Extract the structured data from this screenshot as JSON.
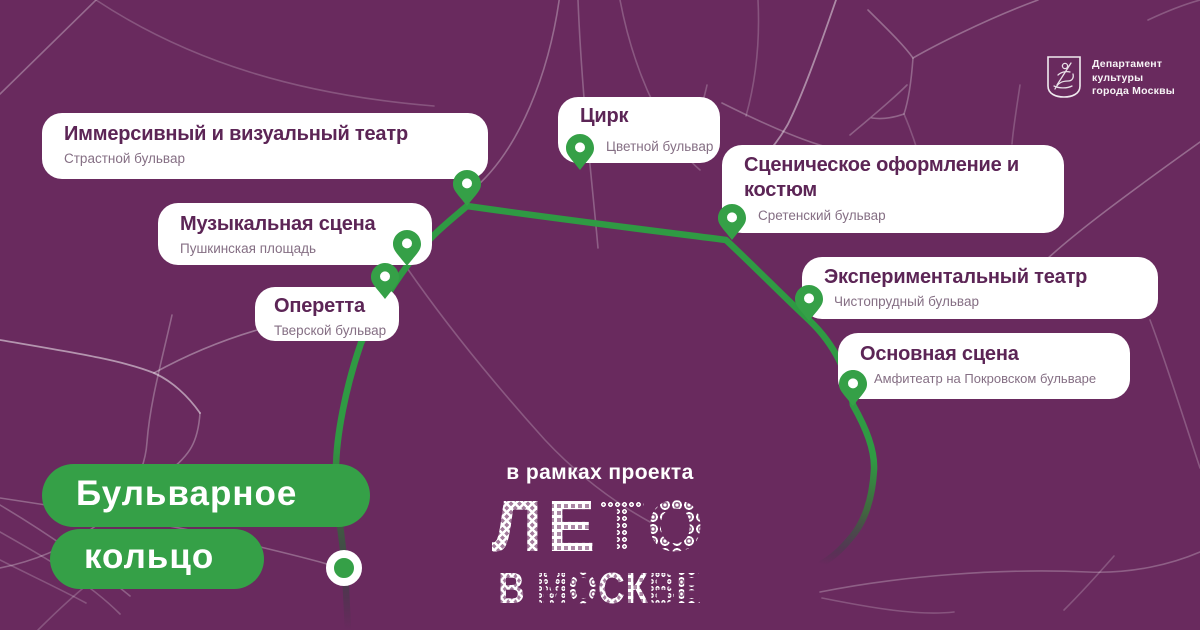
{
  "map": {
    "background_color": "#692A5E",
    "route_color": "#2F9A43",
    "accent_green": "#35A047",
    "title_color": "#5C2556"
  },
  "header": {
    "department_logo": {
      "icon": "moscow-coat-of-arms",
      "line1": "Департамент",
      "line2": "культуры",
      "line3": "города Москвы"
    }
  },
  "venues": [
    {
      "id": "immersive",
      "title": "Иммерсивный и визуальный театр",
      "location": "Страстной бульвар"
    },
    {
      "id": "circus",
      "title": "Цирк",
      "location": "Цветной бульвар"
    },
    {
      "id": "scenic",
      "title": "Сценическое оформление и костюм",
      "location": "Сретенский бульвар"
    },
    {
      "id": "musical",
      "title": "Музыкальная сцена",
      "location": "Пушкинская площадь"
    },
    {
      "id": "operetta",
      "title": "Оперетта",
      "location": "Тверской бульвар"
    },
    {
      "id": "experimental",
      "title": "Экспериментальный театр",
      "location": "Чистопрудный бульвар"
    },
    {
      "id": "main-stage",
      "title": "Основная сцена",
      "location": "Амфитеатр на Покровском бульваре"
    }
  ],
  "ring_label": {
    "line1": "Бульварное",
    "line2": "кольцо"
  },
  "project": {
    "tagline": "в рамках проекта",
    "title": "ЛЕТО",
    "subtitle": "В МОСКВЕ"
  }
}
